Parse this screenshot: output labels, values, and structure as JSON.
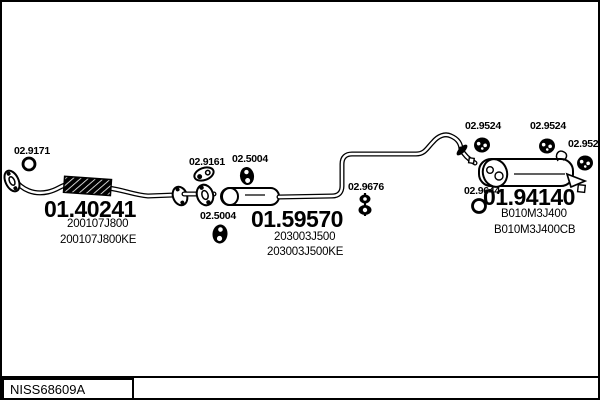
{
  "diagram": {
    "type": "exhaust-system-parts-diagram",
    "colors": {
      "line": "#000000",
      "background": "#ffffff"
    },
    "labels": {
      "ring_front": "02.9171",
      "gasket": "02.9161",
      "hanger_top": "02.5004",
      "hanger_bottom": "02.5004",
      "clamp": "02.9676",
      "mount_1": "02.9524",
      "mount_2": "02.9524",
      "mount_3": "02.9524",
      "ring_rear": "02.9644"
    },
    "parts": {
      "front_pipe": {
        "ref": "01.40241",
        "code": "200107J800",
        "code_alt": "200107J800KE"
      },
      "center_silencer": {
        "ref": "01.59570",
        "code": "203003J500",
        "code_alt": "203003J500KE"
      },
      "rear_silencer": {
        "ref": "01.94140",
        "code": "B010M3J400",
        "code_alt": "B010M3J400CB"
      }
    },
    "icons": {
      "o-ring-icon": "circle outline",
      "flange-icon": "oval with bolt holes",
      "flex-pipe-icon": "hatched black band",
      "rubber-hanger-icon": "black oval with two holes",
      "rubber-mount-icon": "black disc with holes",
      "clamp-icon": "bolted double ring",
      "silencer-icon": "cigar-shaped body"
    }
  },
  "footer": {
    "catalog_code": "NISS68609A"
  }
}
